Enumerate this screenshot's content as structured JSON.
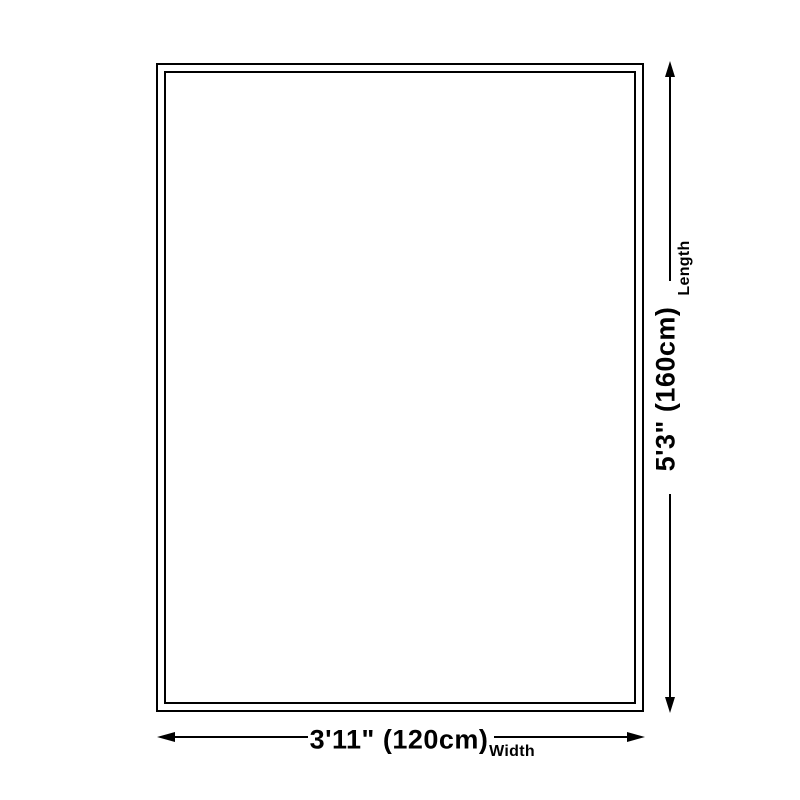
{
  "diagram": {
    "kind": "product-size-diagram",
    "shape": "rectangle-double-border",
    "colors": {
      "line": "#000000",
      "background": "#ffffff"
    },
    "length": {
      "value": "5'3\" (160cm)",
      "label": "Length"
    },
    "width": {
      "value": "3'11\" (120cm)",
      "label": "Width"
    }
  }
}
